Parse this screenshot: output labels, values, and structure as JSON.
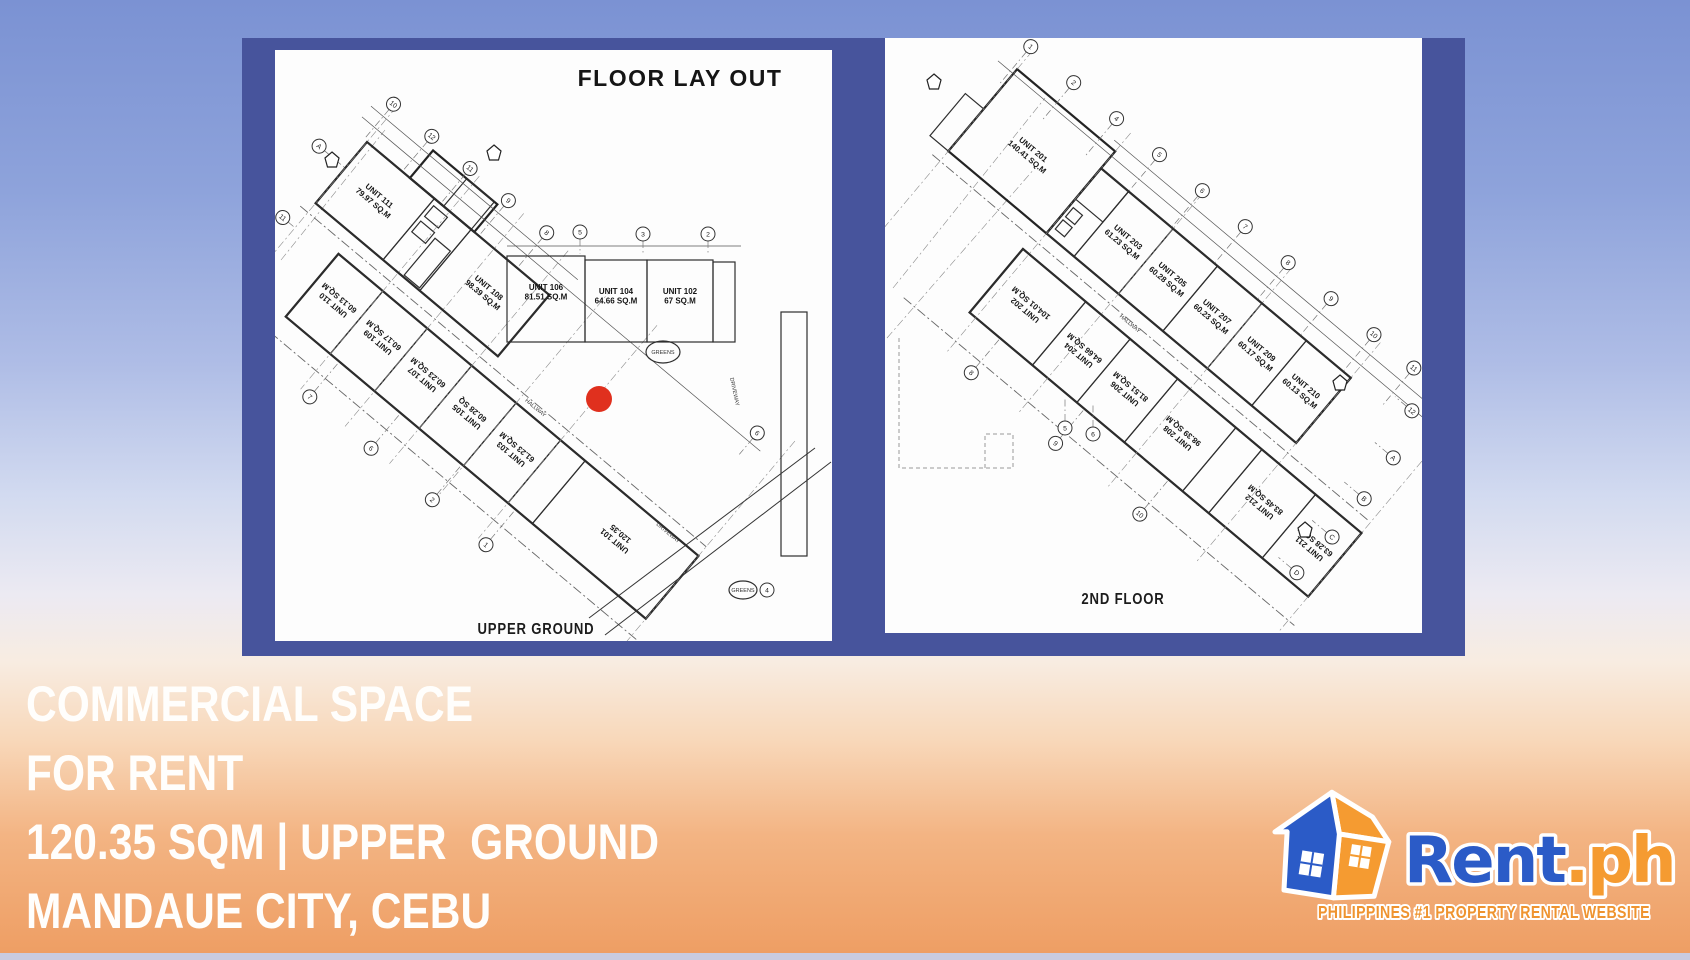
{
  "colors": {
    "panel_navy": "#47549c",
    "marker_red": "#e0301e",
    "brand_blue": "#2b5bc7",
    "brand_orange": "#f59b31",
    "tagline_orange": "#ef9430"
  },
  "plans": {
    "left": {
      "title": "FLOOR LAY OUT",
      "caption": "UPPER GROUND",
      "hallway_label": "HALLWAY",
      "misc": {
        "greens": "GREENS",
        "driveway": "DRIVEWAY"
      },
      "units_upper": [
        {
          "name": "UNIT 111",
          "area": "79.97 SQ.M"
        },
        {
          "name": "UNIT 108",
          "area": "98.39 SQ.M"
        }
      ],
      "units_row": [
        {
          "name": "UNIT 106",
          "area": "81.51 SQ.M"
        },
        {
          "name": "UNIT 104",
          "area": "64.66 SQ.M"
        },
        {
          "name": "UNIT 102",
          "area": "67 SQ.M"
        }
      ],
      "units_lower": [
        {
          "name": "UNIT 110",
          "area": "60.13 SQ.M"
        },
        {
          "name": "UNIT 109",
          "area": "60.17 SQ.M"
        },
        {
          "name": "UNIT 107",
          "area": "60.23 SQ.M"
        },
        {
          "name": "UNIT 105",
          "area": "60.28 SQ"
        },
        {
          "name": "UNIT 103",
          "area": "61.23 SQ.M"
        },
        {
          "name": "UNIT 101",
          "area": "120.35"
        }
      ],
      "bubbles": [
        {
          "g": "g1b",
          "x": -4,
          "y": -46,
          "n": "10",
          "lead": 46
        },
        {
          "g": "g1b",
          "x": 46,
          "y": -46,
          "n": "12",
          "lead": 46
        },
        {
          "g": "g1b",
          "x": 96,
          "y": -46,
          "n": "11",
          "lead": 46
        },
        {
          "g": "g1b",
          "x": 146,
          "y": -46,
          "n": "9",
          "lead": 46
        },
        {
          "g": "g1b",
          "x": 196,
          "y": -46,
          "n": "8",
          "lead": 46
        },
        {
          "g": "g1b",
          "x": 486,
          "y": -28,
          "n": "6",
          "lead": 28
        },
        {
          "g": "g1b",
          "x": -34,
          "y": 34,
          "n": "A",
          "leadx": 34
        },
        {
          "g": "g1b",
          "x": -16,
          "y": 112,
          "n": "11",
          "leadx": 16
        },
        {
          "g": "g1b",
          "x": 120,
          "y": 232,
          "n": "7",
          "lead": -46
        },
        {
          "g": "g1b",
          "x": 200,
          "y": 232,
          "n": "6",
          "lead": -46
        },
        {
          "g": "g1b",
          "x": 280,
          "y": 232,
          "n": "2",
          "lead": -46
        },
        {
          "g": "g1b",
          "x": 350,
          "y": 232,
          "n": "1",
          "lead": -46
        },
        {
          "g": "g1a",
          "x": 305,
          "y": 182,
          "n": "5",
          "lead": 22
        },
        {
          "g": "g1a",
          "x": 368,
          "y": 184,
          "n": "3",
          "lead": 20
        },
        {
          "g": "g1a",
          "x": 433,
          "y": 184,
          "n": "2",
          "lead": 20
        },
        {
          "g": "g1a",
          "x": 492,
          "y": 540,
          "n": "4"
        }
      ]
    },
    "right": {
      "caption": "2ND FLOOR",
      "hallway_label": "HALLWAY",
      "units_upper": [
        {
          "name": "UNIT 201",
          "area": "140.41 SQ.M"
        },
        {
          "name": "UNIT 203",
          "area": "61.23 SQ.M"
        },
        {
          "name": "UNIT 205",
          "area": "60.28 SQ.M"
        },
        {
          "name": "UNIT 207",
          "area": "60.23 SQ.M"
        },
        {
          "name": "UNIT 209",
          "area": "60.17 SQ.M"
        },
        {
          "name": "UNIT 210",
          "area": "60.13 SQ.M"
        }
      ],
      "units_lower": [
        {
          "name": "UNIT 202",
          "area": "104.01 SQ.M"
        },
        {
          "name": "UNIT 204",
          "area": "64.66 SQ.M"
        },
        {
          "name": "UNIT 206",
          "area": "81.51 SQ.M"
        },
        {
          "name": "UNIT 208",
          "area": "98.39 SQ.M"
        },
        {
          "name": "UNIT 212",
          "area": "83.45 SQ.M"
        },
        {
          "name": "UNIT 211",
          "area": "63.28 SQ.M"
        }
      ],
      "bubbles": [
        {
          "g": "g2b",
          "x": -4,
          "y": -48,
          "n": "1",
          "lead": 48
        },
        {
          "g": "g2b",
          "x": 52,
          "y": -48,
          "n": "2",
          "lead": 48
        },
        {
          "g": "g2b",
          "x": 108,
          "y": -48,
          "n": "4",
          "lead": 48
        },
        {
          "g": "g2b",
          "x": 164,
          "y": -48,
          "n": "5",
          "lead": 48
        },
        {
          "g": "g2b",
          "x": 220,
          "y": -48,
          "n": "6",
          "lead": 48
        },
        {
          "g": "g2b",
          "x": 276,
          "y": -48,
          "n": "7",
          "lead": 48
        },
        {
          "g": "g2b",
          "x": 332,
          "y": -48,
          "n": "8",
          "lead": 48
        },
        {
          "g": "g2b",
          "x": 388,
          "y": -48,
          "n": "9",
          "lead": 48
        },
        {
          "g": "g2b",
          "x": 444,
          "y": -48,
          "n": "10",
          "lead": 48
        },
        {
          "g": "g2b",
          "x": 496,
          "y": -48,
          "n": "11",
          "lead": 48
        },
        {
          "g": "g2b",
          "x": 522,
          "y": -14,
          "n": "12",
          "leadx": -22
        },
        {
          "g": "g2b",
          "x": 538,
          "y": 34,
          "n": "A",
          "leadx": -24
        },
        {
          "g": "g2b",
          "x": 542,
          "y": 84,
          "n": "B",
          "leadx": -26
        },
        {
          "g": "g2b",
          "x": 542,
          "y": 134,
          "n": "C",
          "leadx": -26
        },
        {
          "g": "g2b",
          "x": 538,
          "y": 184,
          "n": "D",
          "leadx": -24
        },
        {
          "g": "g2b",
          "x": 160,
          "y": 240,
          "n": "8",
          "lead": -45
        },
        {
          "g": "g2b",
          "x": 270,
          "y": 240,
          "n": "9",
          "lead": -45
        },
        {
          "g": "g2b",
          "x": 380,
          "y": 240,
          "n": "10",
          "lead": -45
        },
        {
          "g": "g2a",
          "x": 180,
          "y": 390,
          "n": "5",
          "lead": -30
        },
        {
          "g": "g2a",
          "x": 208,
          "y": 396,
          "n": "6",
          "lead": -30
        }
      ]
    }
  },
  "marker": {
    "label": "highlighted-unit-location"
  },
  "headline": {
    "line1": "COMMERCIAL SPACE",
    "line2": "FOR RENT",
    "line3": "120.35 SQM | UPPER  GROUND",
    "line4": "MANDAUE CITY, CEBU"
  },
  "logo": {
    "brand": "Rent",
    "suffix": ".ph",
    "tagline": "PHILIPPINES #1 PROPERTY RENTAL WEBSITE"
  }
}
